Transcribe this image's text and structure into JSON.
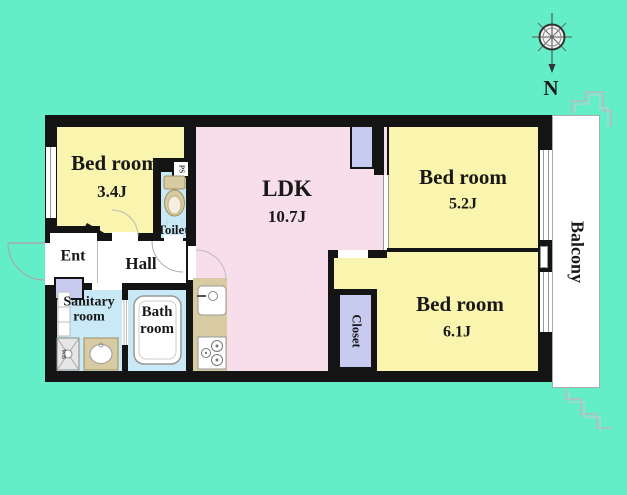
{
  "colors": {
    "bg": "#63EEC7",
    "wall": "#141414",
    "room-yellow": "#F9F5AE",
    "room-pink": "#F8DEEA",
    "room-blue": "#C8E9F5",
    "room-lavender": "#C7CBEF",
    "fixture-tan": "#D9CBA1",
    "line-gray": "#999999",
    "balcony-line": "#AAAAAA"
  },
  "compass": {
    "north_label": "N"
  },
  "rooms": {
    "bedroom1": {
      "name": "Bed room",
      "size": "3.4J"
    },
    "bedroom2": {
      "name": "Bed room",
      "size": "5.2J"
    },
    "bedroom3": {
      "name": "Bed room",
      "size": "6.1J"
    },
    "ldk": {
      "name": "LDK",
      "size": "10.7J"
    },
    "toilet": {
      "name": "Toilet"
    },
    "entrance": {
      "name": "Ent"
    },
    "hall": {
      "name": "Hall"
    },
    "sanitary": {
      "line1": "Sanitary",
      "line2": "room"
    },
    "bath": {
      "line1": "Bath",
      "line2": "room"
    },
    "closet": {
      "name": "Closet"
    },
    "balcony": {
      "name": "Balcony"
    },
    "pipe_shaft": {
      "name": "PS"
    },
    "washer": {
      "name": "WB"
    }
  }
}
